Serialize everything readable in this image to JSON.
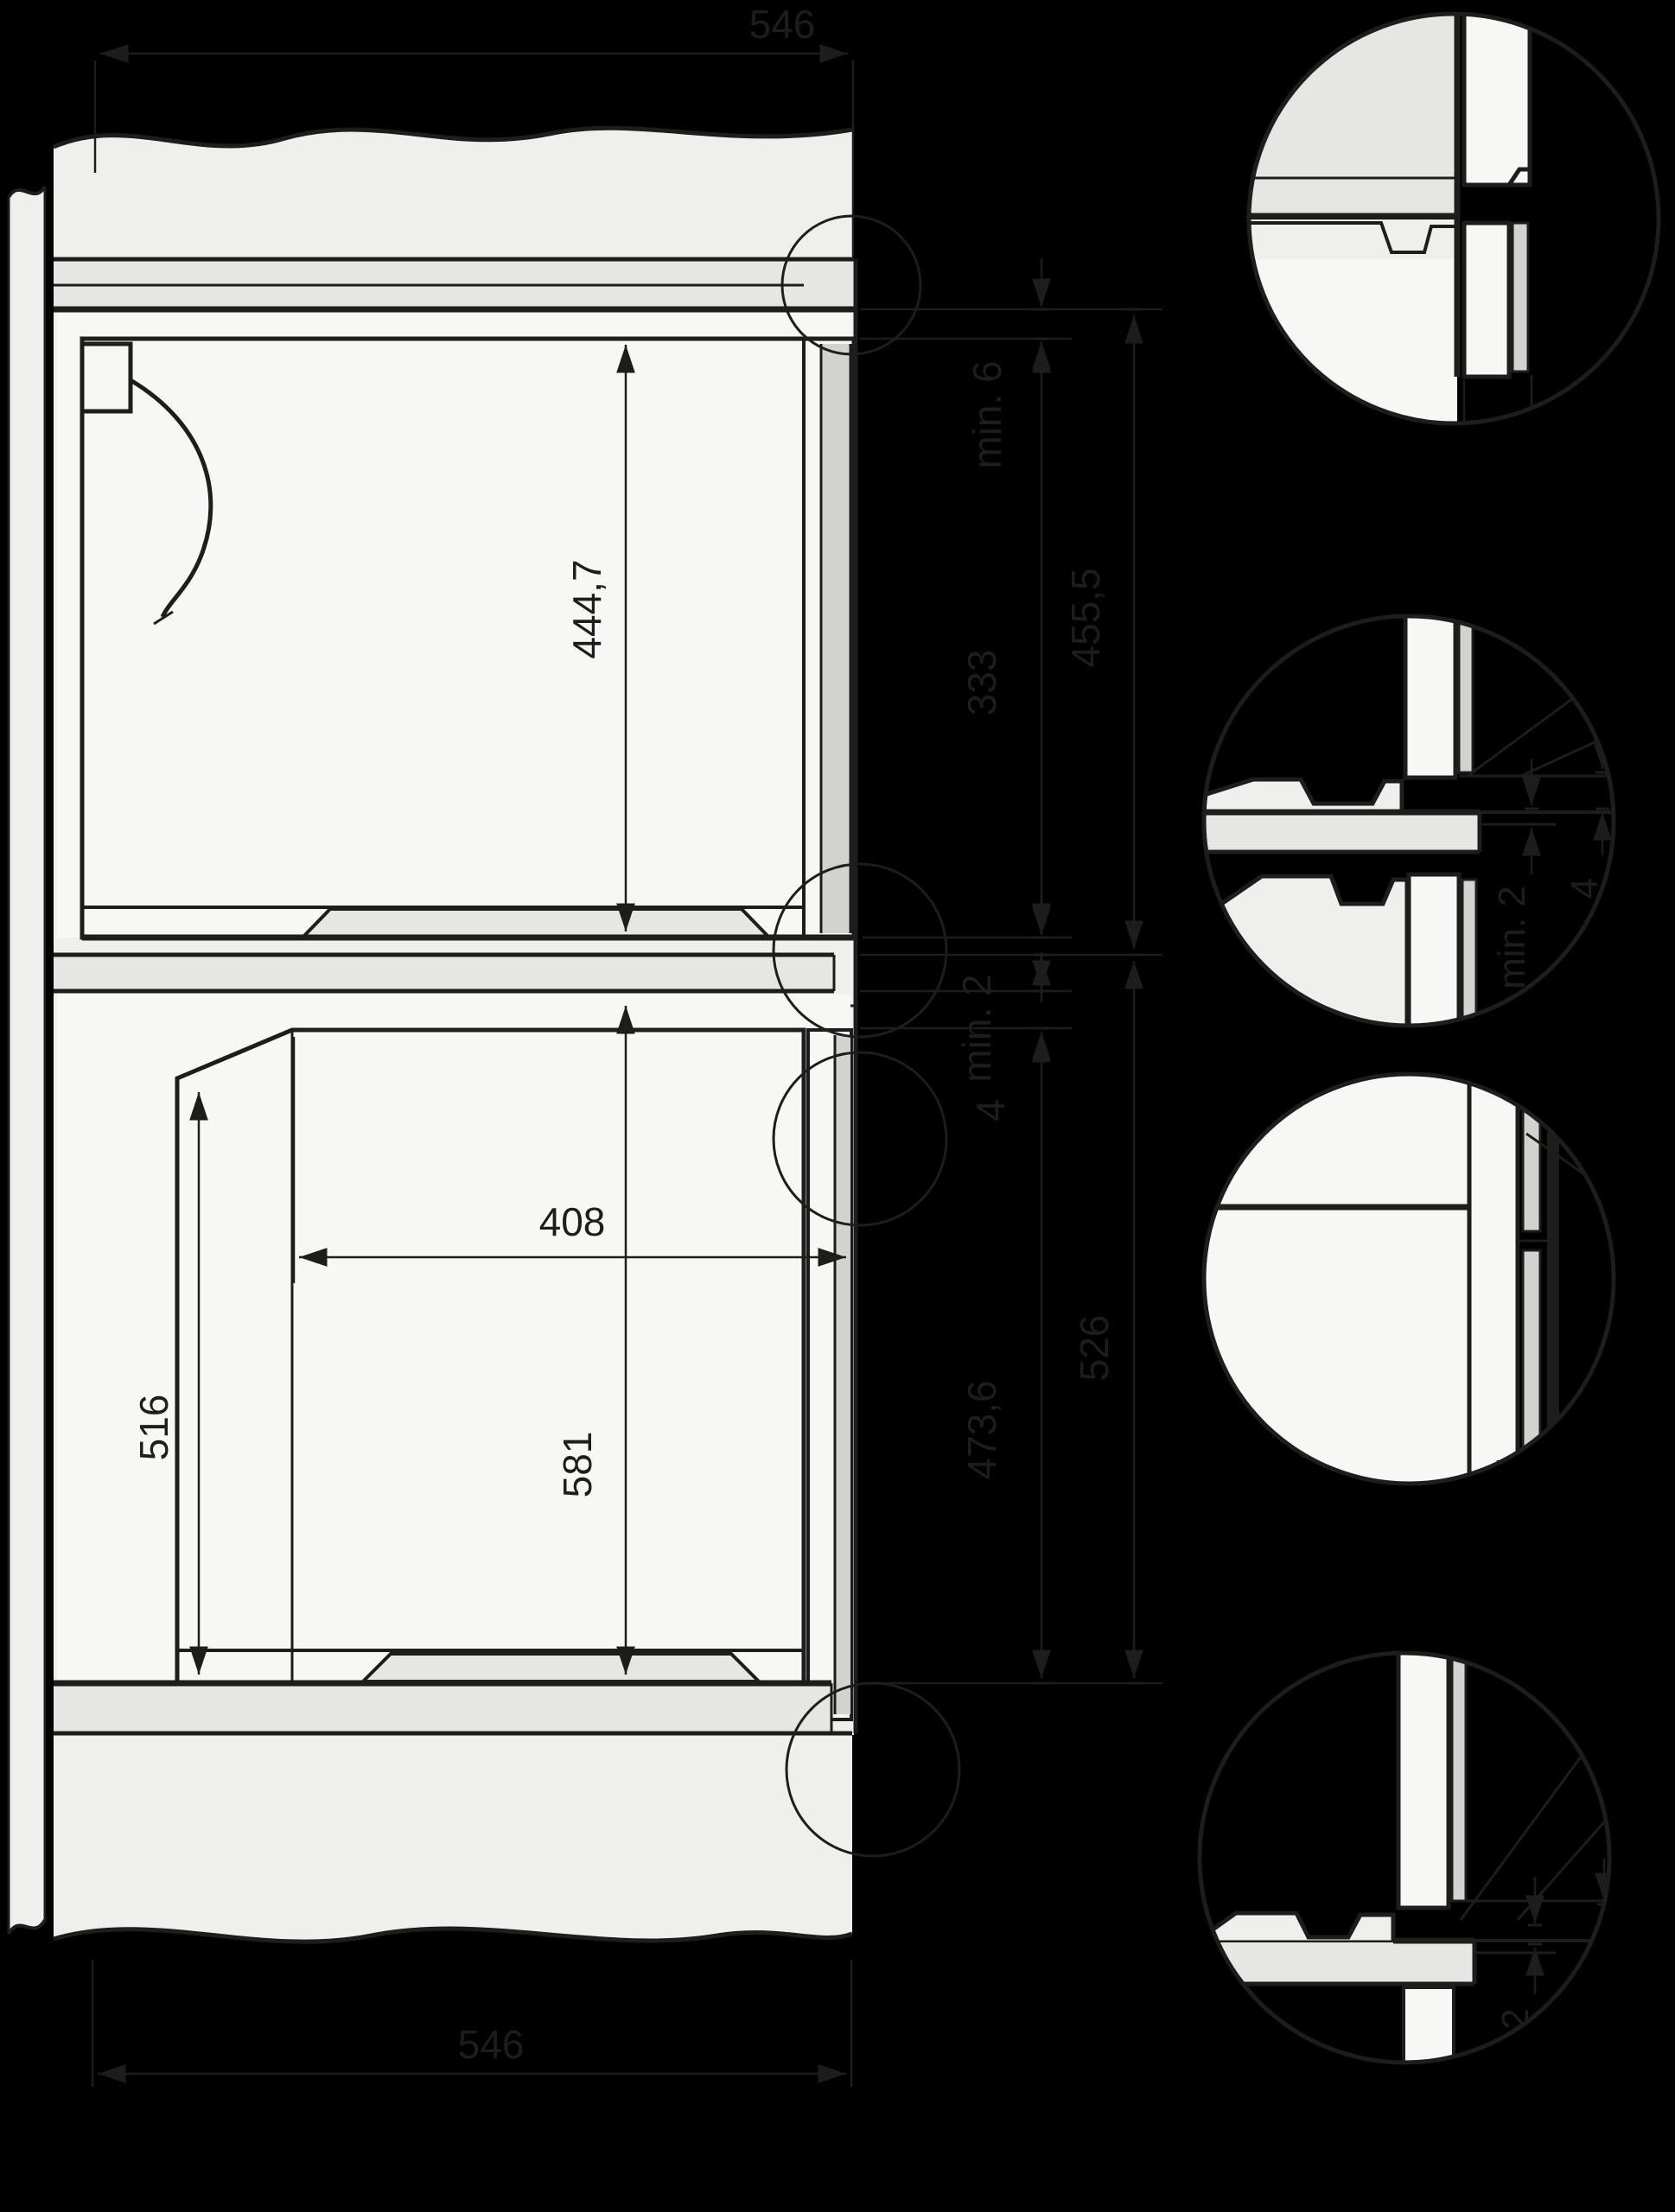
{
  "colors": {
    "background": "#000000",
    "line": "#1d1d1b",
    "panel_light": "#efefed",
    "cavity_white": "#f7f7f6",
    "slab_gray": "#e6e6e4",
    "door_gray": "#d2d2d0"
  },
  "dims": {
    "top_width": "546",
    "upper_appliance_height": "444,7",
    "upper_top_gap": "min. 6",
    "upper_rear_height": "333",
    "upper_niche_height": "455,5",
    "mid_gap": "min. 2",
    "mid_step": "4",
    "lower_front_height": "473,6",
    "lower_niche_height": "526",
    "lower_depth": "408",
    "lower_rear_height": "516",
    "lower_appliance_height": "581",
    "bottom_width": "546"
  },
  "details": {
    "top_gap": "8",
    "mid_gap": "min. 2",
    "mid_step": "4",
    "door_angle": "22°/23,3°",
    "bottom_gap": "min. 2",
    "bottom_step": "4"
  }
}
